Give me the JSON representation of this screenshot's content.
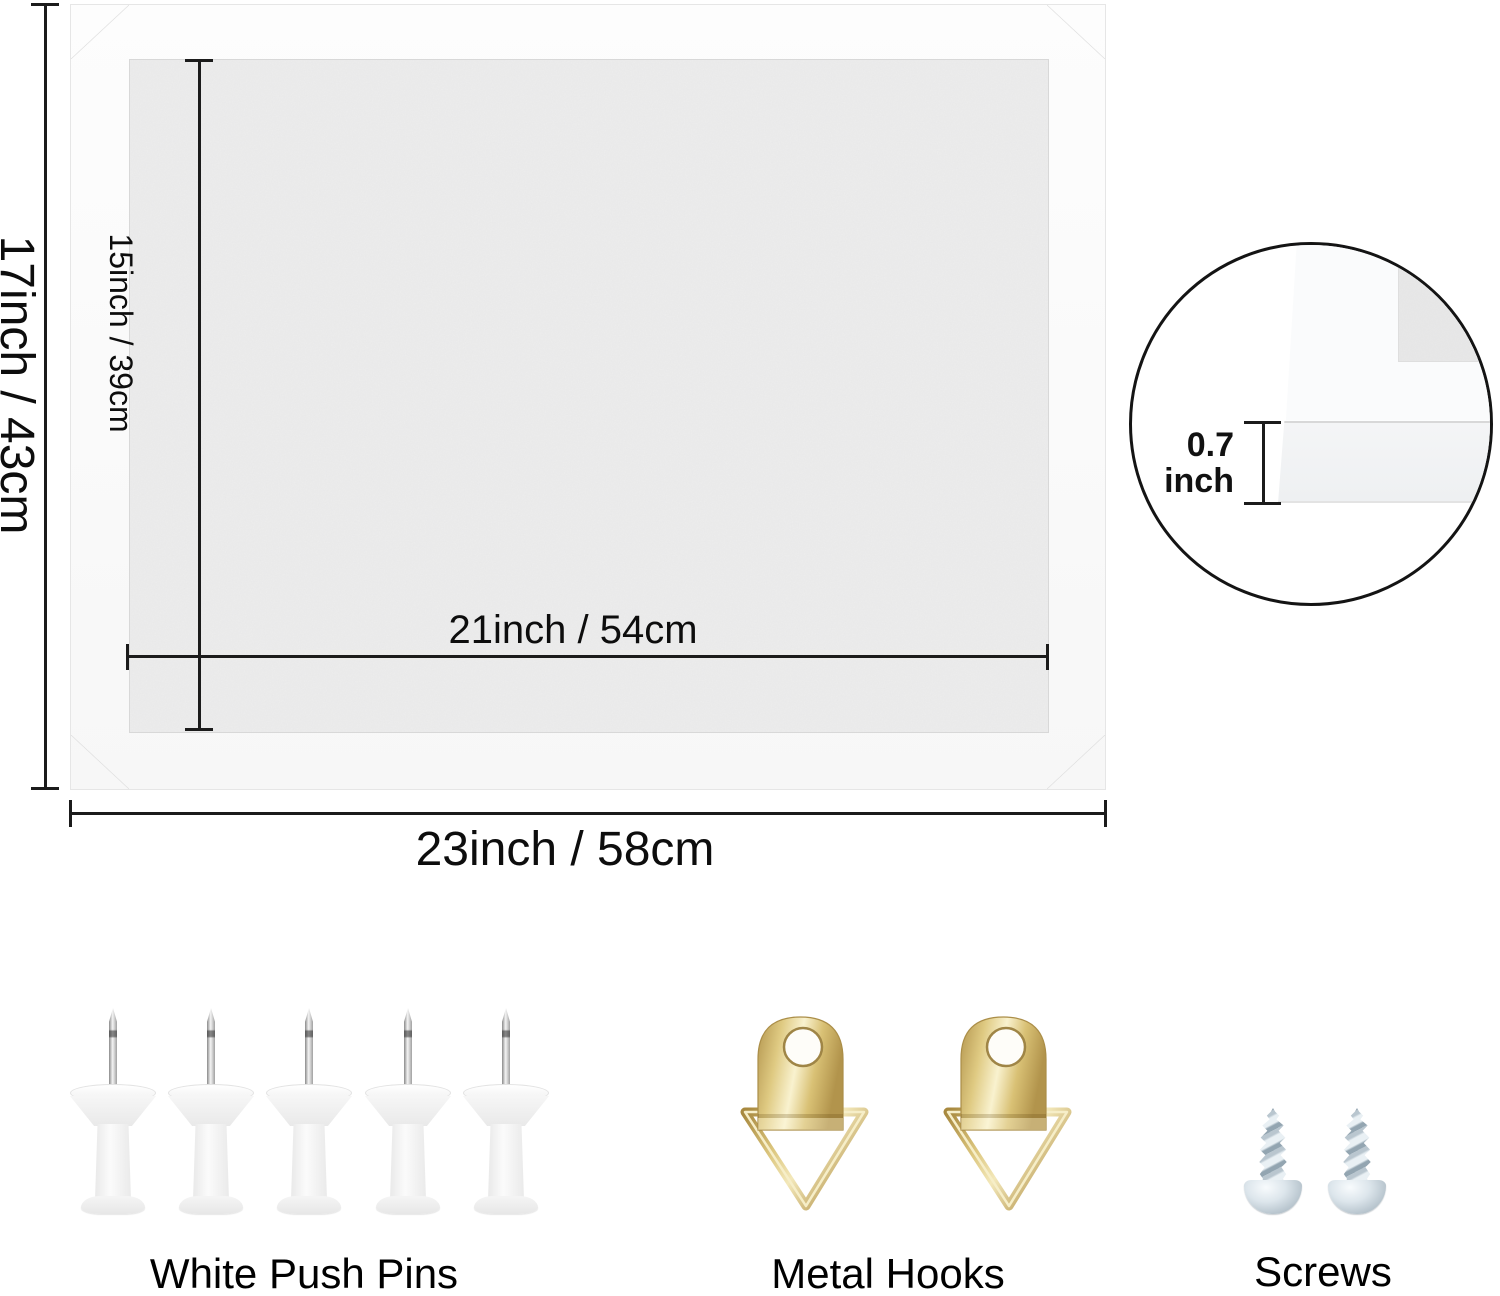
{
  "dimensions": {
    "outer_height": "17inch / 43cm",
    "inner_height": "15inch / 39cm",
    "inner_width": "21inch / 54cm",
    "outer_width": "23inch / 58cm",
    "frame_thickness_value": "0.7",
    "frame_thickness_unit": "inch"
  },
  "hardware": {
    "push_pins_label": "White Push Pins",
    "push_pins_count": 5,
    "metal_hooks_label": "Metal Hooks",
    "metal_hooks_count": 2,
    "screws_label": "Screws",
    "screws_count": 2
  },
  "colors": {
    "background": "#ffffff",
    "dimension_line": "#1b1b1b",
    "text": "#111111",
    "felt_gray": "#ededed",
    "frame_white": "#fcfcfc",
    "hook_brass": "#d9c178",
    "screw_steel": "#c9d4dc",
    "pin_plastic": "#f5f5f5"
  }
}
